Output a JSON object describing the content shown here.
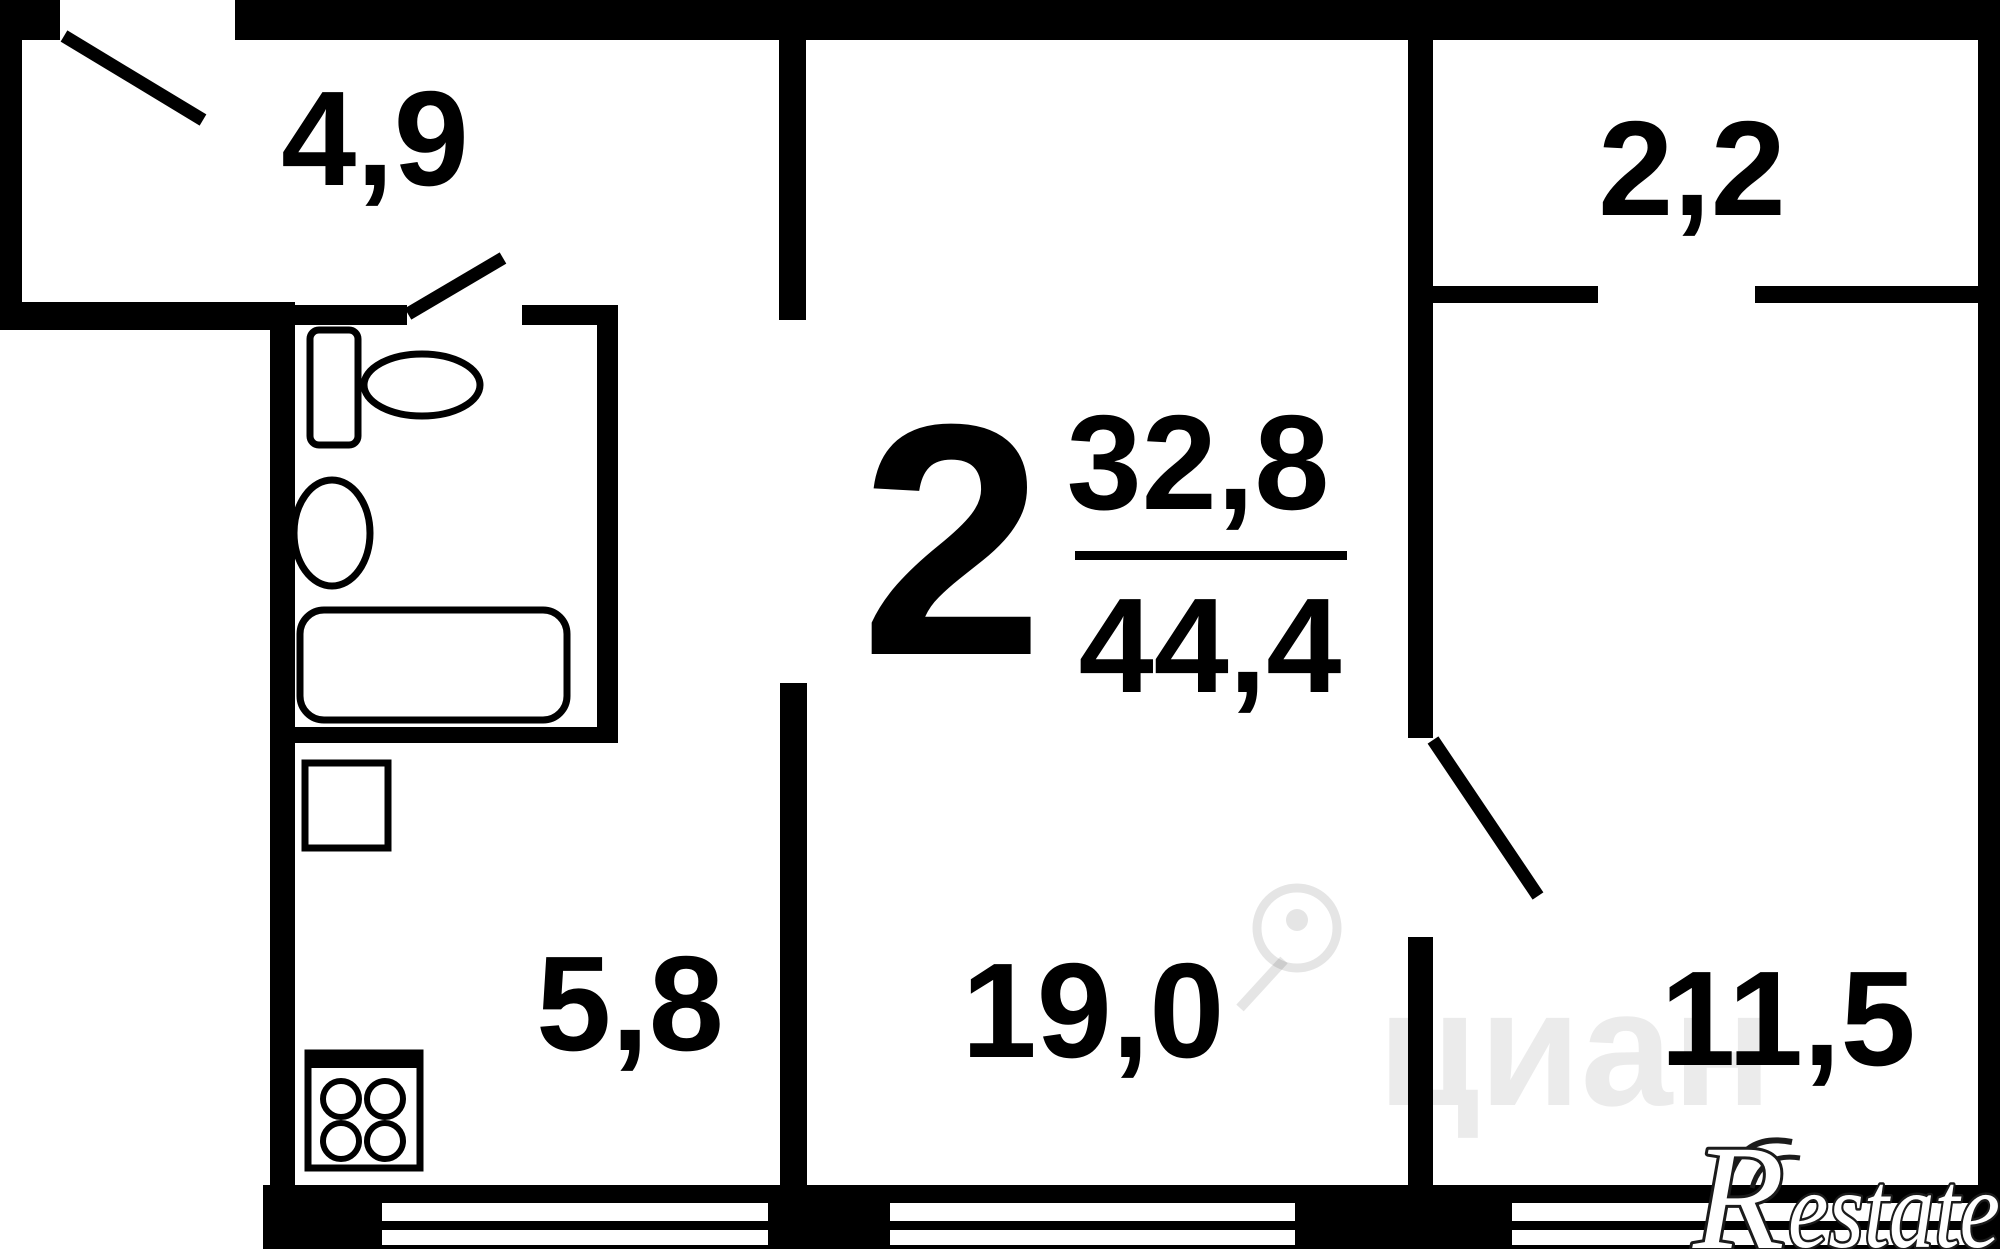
{
  "colors": {
    "wall": "#000000",
    "background": "#ffffff",
    "label": "#000000",
    "watermark_fill": "rgba(0,0,0,0.08)",
    "watermark_stroke": "rgba(0,0,0,0.10)",
    "logo_fill": "#ffffff",
    "logo_outline": "#1b1b1b"
  },
  "apartment": {
    "rooms_count": "2",
    "living_area": "32,8",
    "total_area": "44,4"
  },
  "rooms": {
    "hallway": "4,9",
    "balcony": "2,2",
    "kitchen": "5,8",
    "living_room": "19,0",
    "bedroom": "11,5"
  },
  "watermark": {
    "text": "циан"
  },
  "logo": {
    "initial": "R",
    "rest": "estate"
  }
}
